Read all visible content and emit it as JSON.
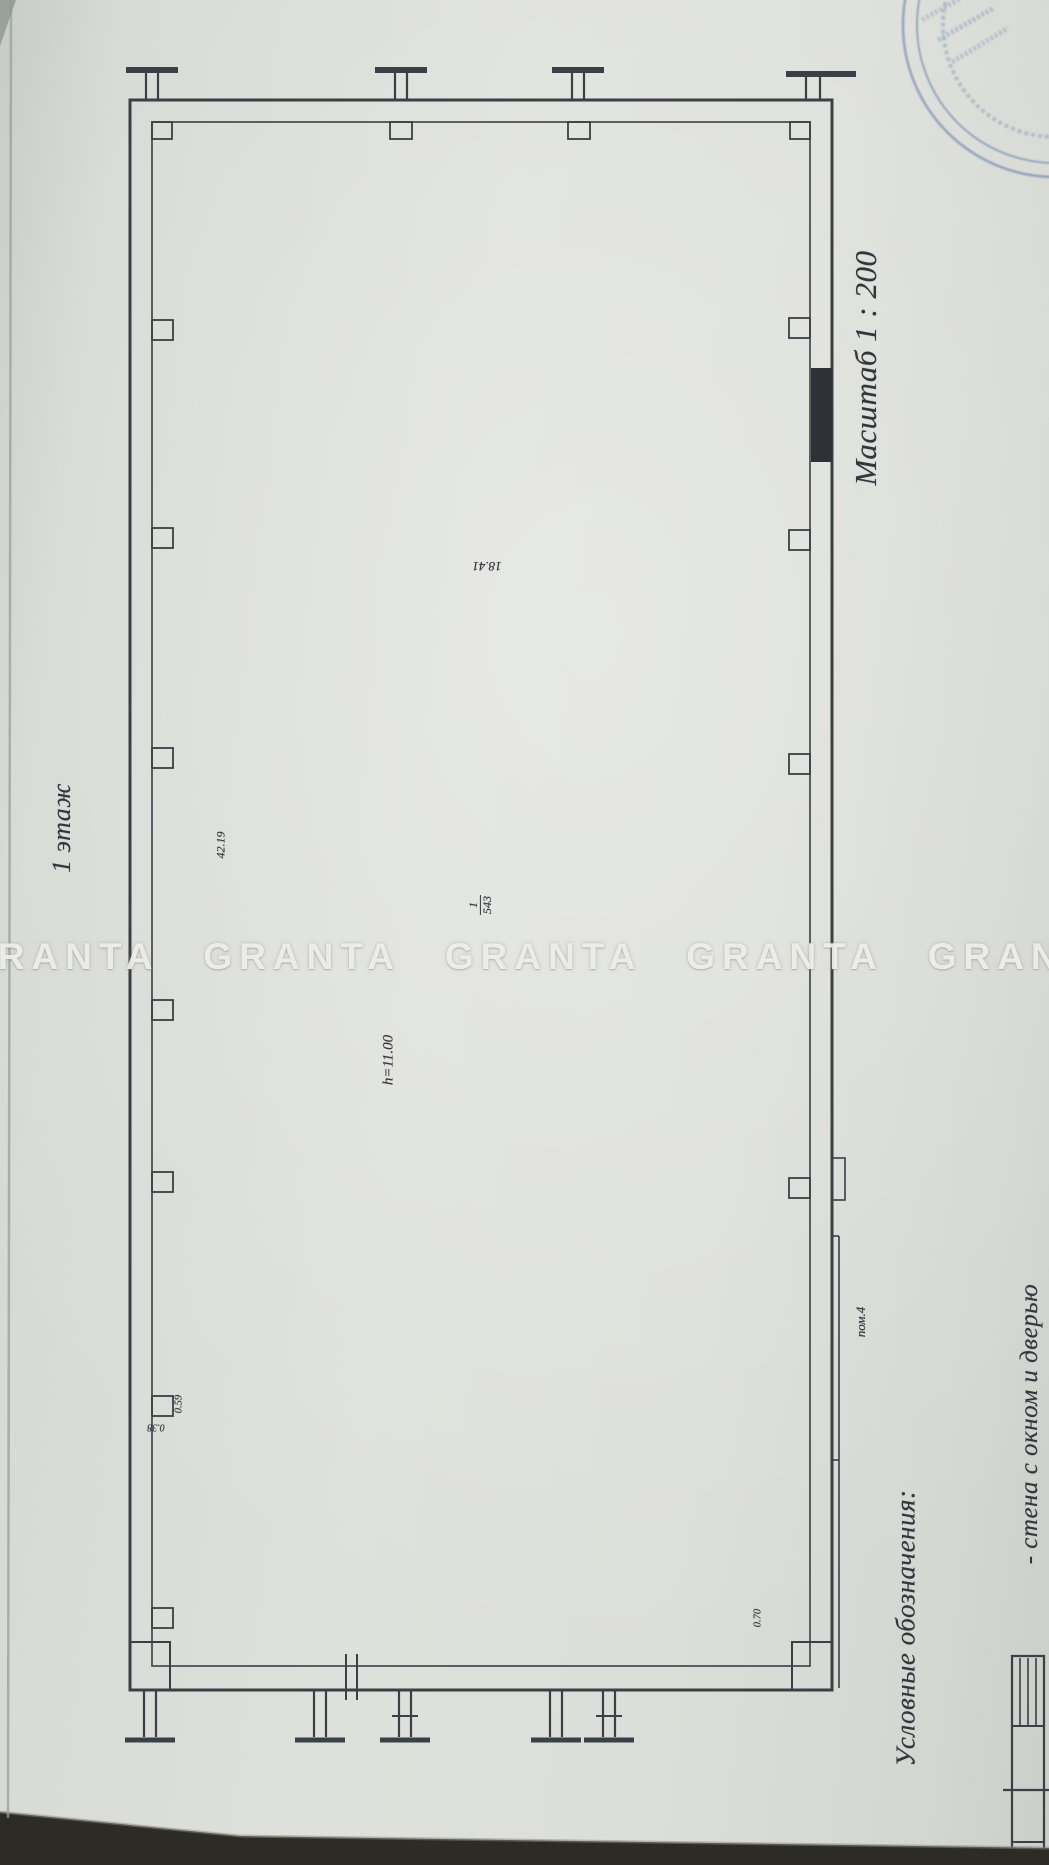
{
  "sheet": {
    "floor_label": "1 этаж",
    "scale_label": "Масштаб 1 : 200",
    "legend": {
      "title": "Условные обозначения:",
      "item_label": "- стена с окном и дверью",
      "symbol_name": "wall-with-window-and-door-symbol"
    },
    "plan": {
      "room_label": "пом.4",
      "length_dim": "42.19",
      "width_dim": "18.41",
      "height_label": "h=11.00",
      "room_fraction_numerator": "1",
      "room_fraction_denominator": "543",
      "small_dim_a": "0.59",
      "small_dim_b": "0.38",
      "small_dim_c": "0.70"
    }
  },
  "watermark": {
    "line": "GRANTA GRANTA GRANTA GRANTA GRANTA GRANTA"
  },
  "colors": {
    "ink": "#3b3f46",
    "stamp_blue": "#6d83ab",
    "paper": "#d9dcd7"
  }
}
